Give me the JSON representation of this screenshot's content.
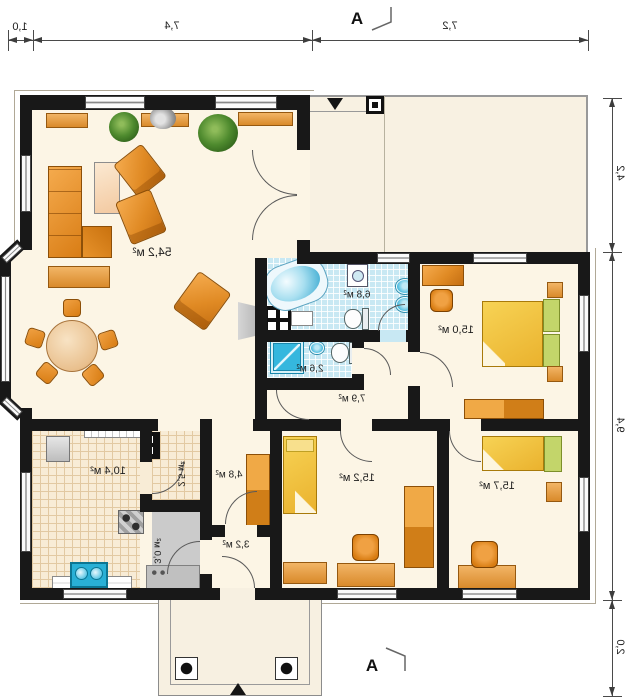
{
  "sections": {
    "top": "A",
    "bottom": "A"
  },
  "dims": {
    "top": [
      "1,0",
      "7,4",
      "7,2"
    ],
    "right": [
      "4,2",
      "9,4",
      "2,0"
    ]
  },
  "rooms": {
    "living": {
      "area": "54,2 м²"
    },
    "bathroom": {
      "area": "6,8 м²"
    },
    "wc": {
      "area": "2,6 м²"
    },
    "bedroom_right": {
      "area": "15,0 м²"
    },
    "hallway": {
      "area": "7,9 м²"
    },
    "kitchen": {
      "area": "10,4 м²"
    },
    "pantry": {
      "area": "2,5 м²"
    },
    "boiler": {
      "area": "3,0 м²"
    },
    "hall_small": {
      "area": "4,8 м²"
    },
    "vestibule": {
      "area": "3,2 м²"
    },
    "bedroom_left": {
      "area": "15,2 м²"
    },
    "bedroom_lower": {
      "area": "15,7 м²"
    }
  },
  "colors": {
    "wall": "#181818",
    "floor_cream": "#fcf5e5",
    "tile_blue": "#c8e8f3",
    "kitchen_tile": "#f8ecd6",
    "furniture_orange": "#e08a24",
    "bed_yellow": "#f2c23c",
    "accent_green": "#c3d56a",
    "water_blue": "#3fb6dc",
    "terrace": "#f8f1e2",
    "boiler_gray": "#cbcbcb"
  }
}
